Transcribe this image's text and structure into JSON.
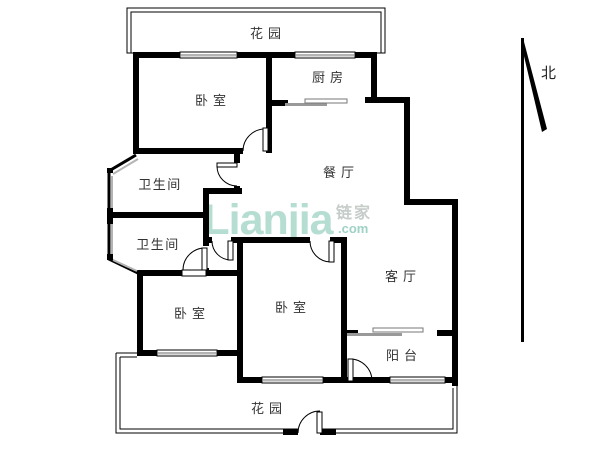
{
  "floorplan": {
    "rooms": {
      "garden_top": {
        "label": "花园"
      },
      "bedroom_top_left": {
        "label": "卧室"
      },
      "kitchen": {
        "label": "厨房"
      },
      "bathroom_top": {
        "label": "卫生间"
      },
      "dining_room": {
        "label": "餐厅"
      },
      "bathroom_bottom": {
        "label": "卫生间"
      },
      "living_room": {
        "label": "客厅"
      },
      "bedroom_bottom_left": {
        "label": "卧室"
      },
      "bedroom_bottom_middle": {
        "label": "卧室"
      },
      "balcony": {
        "label": "阳台"
      },
      "garden_bottom": {
        "label": "花园"
      }
    },
    "compass": {
      "north_label": "北"
    },
    "watermark": {
      "brand": "Lianjia",
      "brand_cjk": "链家",
      "suffix": ".com"
    },
    "colors": {
      "wall": "#000000",
      "window": "#b3b3b3",
      "label": "#333333",
      "watermark_green": "#b5ddd2",
      "watermark_gray": "#c6cdc9",
      "watermark_teal": "#9ed2c5"
    }
  }
}
